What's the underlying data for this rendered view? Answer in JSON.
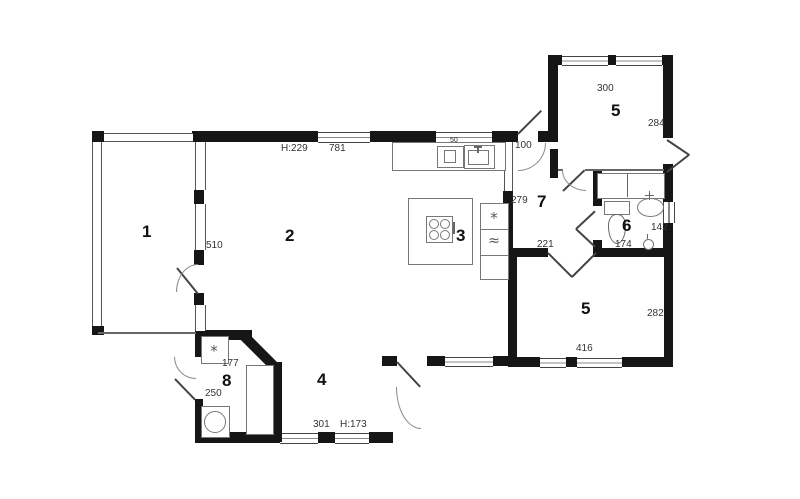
{
  "plan": {
    "rooms": {
      "r1": "1",
      "r2": "2",
      "r3": "3",
      "r4": "4",
      "r5_top": "5",
      "r5_bottom": "5",
      "r6": "6",
      "r7": "7",
      "r8": "8"
    },
    "dims": {
      "ceiling_main": "H:229",
      "top_wall": "781",
      "counter": "50",
      "entry": "100",
      "r5t_width": "300",
      "r5t_height": "284",
      "kitchen_wall": "279",
      "r1_wall": "510",
      "hall_wall": "221",
      "r6_width": "142",
      "r6_depth": "174",
      "r5b_height": "282",
      "r5b_width": "416",
      "r8_top": "177",
      "r8_height": "250",
      "r4_width": "301",
      "ceiling_low": "H:173"
    },
    "icons": {
      "fan": "*",
      "waves": "≈"
    },
    "colors": {
      "wall": "#161616",
      "line": "#555",
      "text": "#222"
    }
  }
}
